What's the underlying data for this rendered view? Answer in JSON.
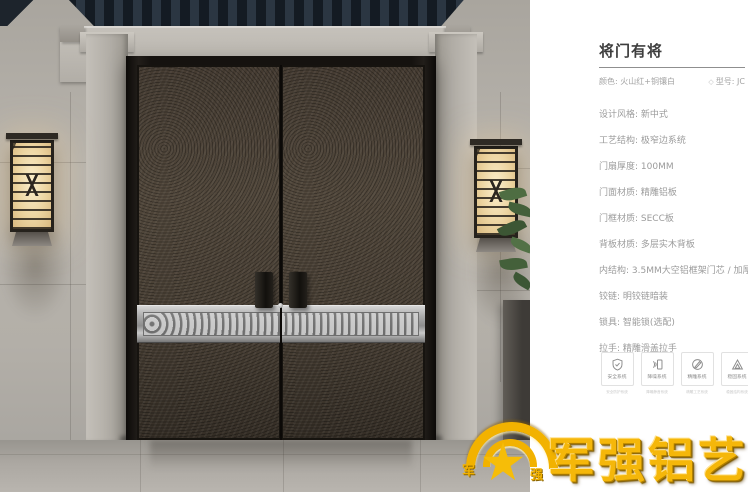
{
  "panel": {
    "title": "将门有将",
    "subtitle_left": "颜色: 火山红+铜镶白",
    "subtitle_right": "型号: JC",
    "model_icon": "◇",
    "specs": [
      "设计风格: 新中式",
      "工艺结构: 极窄边系统",
      "门扇厚度: 100MM",
      "门面材质: 精雕铝板",
      "门框材质: SECC板",
      "背板材质: 多层实木背板",
      "内结构: 3.5MM大空铝框架门芯 / 加厚加密航空铝板",
      "铰链: 明铰链暗装",
      "锁具: 智能锁(选配)",
      "拉手: 精雕滑盖拉手"
    ],
    "features": [
      {
        "icon": "shield-icon",
        "label": "安全系统",
        "caption": "安全防护系统"
      },
      {
        "icon": "soundproof-icon",
        "label": "降噪系统",
        "caption": "降噪静音系统"
      },
      {
        "icon": "carving-icon",
        "label": "精雕系统",
        "caption": "精雕工艺系统"
      },
      {
        "icon": "structure-icon",
        "label": "稳固系统",
        "caption": "稳固结构系统"
      }
    ]
  },
  "logo": {
    "text": "军强铝艺",
    "emblem_left": "军",
    "emblem_right": "强"
  },
  "colors": {
    "brand_gold": "#f2b200",
    "panel_text": "#9b9b9b",
    "title_text": "#3e3e3e",
    "door_bronze": "#483f34",
    "band_silver": "#b9b9b9"
  }
}
